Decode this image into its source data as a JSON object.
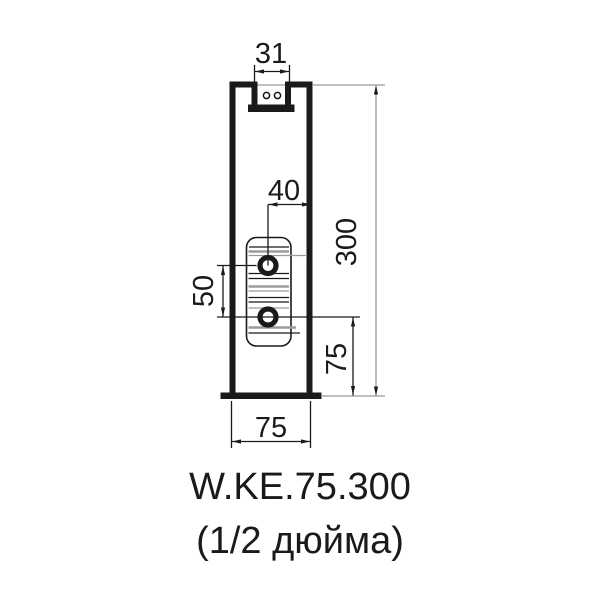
{
  "drawing": {
    "kind": "radiator-profile-section",
    "product_code": "W.KE.75.300",
    "connection_size": "(1/2 дюйма)",
    "dims": {
      "top_notch_width": "31",
      "hole_to_edge": "40",
      "total_height": "300",
      "hole_spacing": "50",
      "hole_to_bottom": "75",
      "profile_width": "75"
    },
    "colors": {
      "line": "#1a1a1a",
      "construction_gray": "#9b9b9b",
      "background": "#ffffff"
    }
  }
}
